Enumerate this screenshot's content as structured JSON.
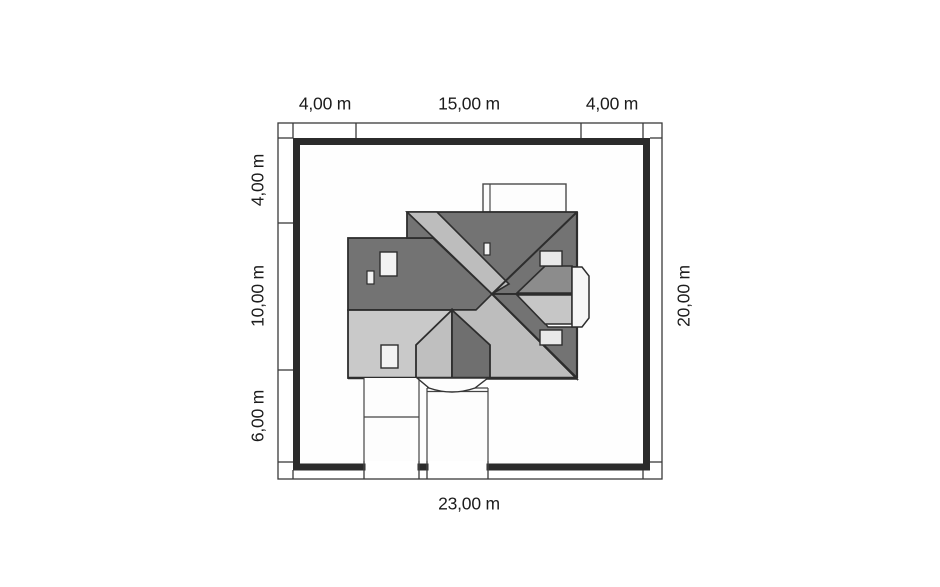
{
  "drawing": {
    "type": "house-site-plan-roof-view",
    "plot": {
      "width_label": "23,00 m",
      "depth_label": "20,00 m"
    }
  },
  "dimensions": {
    "top": [
      "4,00 m",
      "15,00 m",
      "4,00 m"
    ],
    "left": [
      "4,00 m",
      "10,00 m",
      "6,00 m"
    ],
    "right": "20,00 m",
    "bottom": "23,00 m"
  },
  "colors": {
    "roof_dark": "#737373",
    "roof_medium": "#8c8c8c",
    "roof_light": "#c9c9c9",
    "roof_band_light": "#bdbdbd",
    "chimney_fill": "#f0f0f0",
    "bay_fill": "#f6f6f6",
    "outline": "#2d2d2d",
    "plot_border": "#2b2b2b",
    "dim_line": "#3a3a3a",
    "background": "#ffffff"
  }
}
